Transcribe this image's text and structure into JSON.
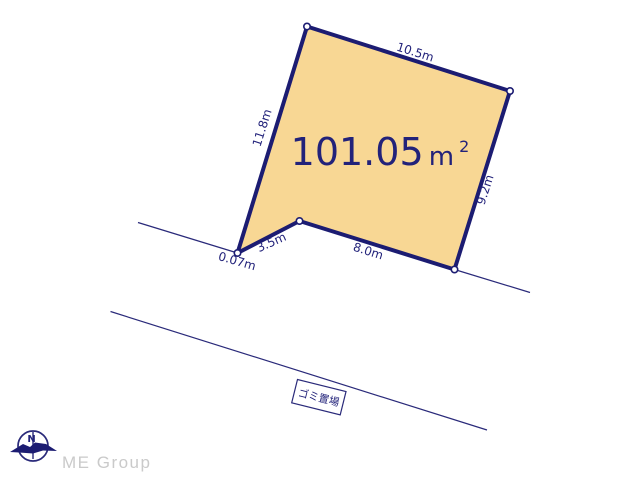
{
  "diagram": {
    "title_hint": "land-plot-survey-diagram",
    "area": {
      "value": "101.05",
      "unit": "m",
      "superscript": "2"
    },
    "dimensions": {
      "top": "10.5m",
      "left": "11.8m",
      "right": "9.2m",
      "bottom": "8.0m",
      "bottom_left": "3.5m",
      "corner": "0.07m"
    },
    "garbage_area_label": "ゴミ置場",
    "compass_north_label": "N"
  },
  "footer": {
    "logo_text": "ME Group"
  },
  "colors": {
    "plot_fill": "#f8d794",
    "outline_navy": "#1c1c72",
    "text_navy": "#22227a",
    "logo_gray": "#cacaca"
  }
}
